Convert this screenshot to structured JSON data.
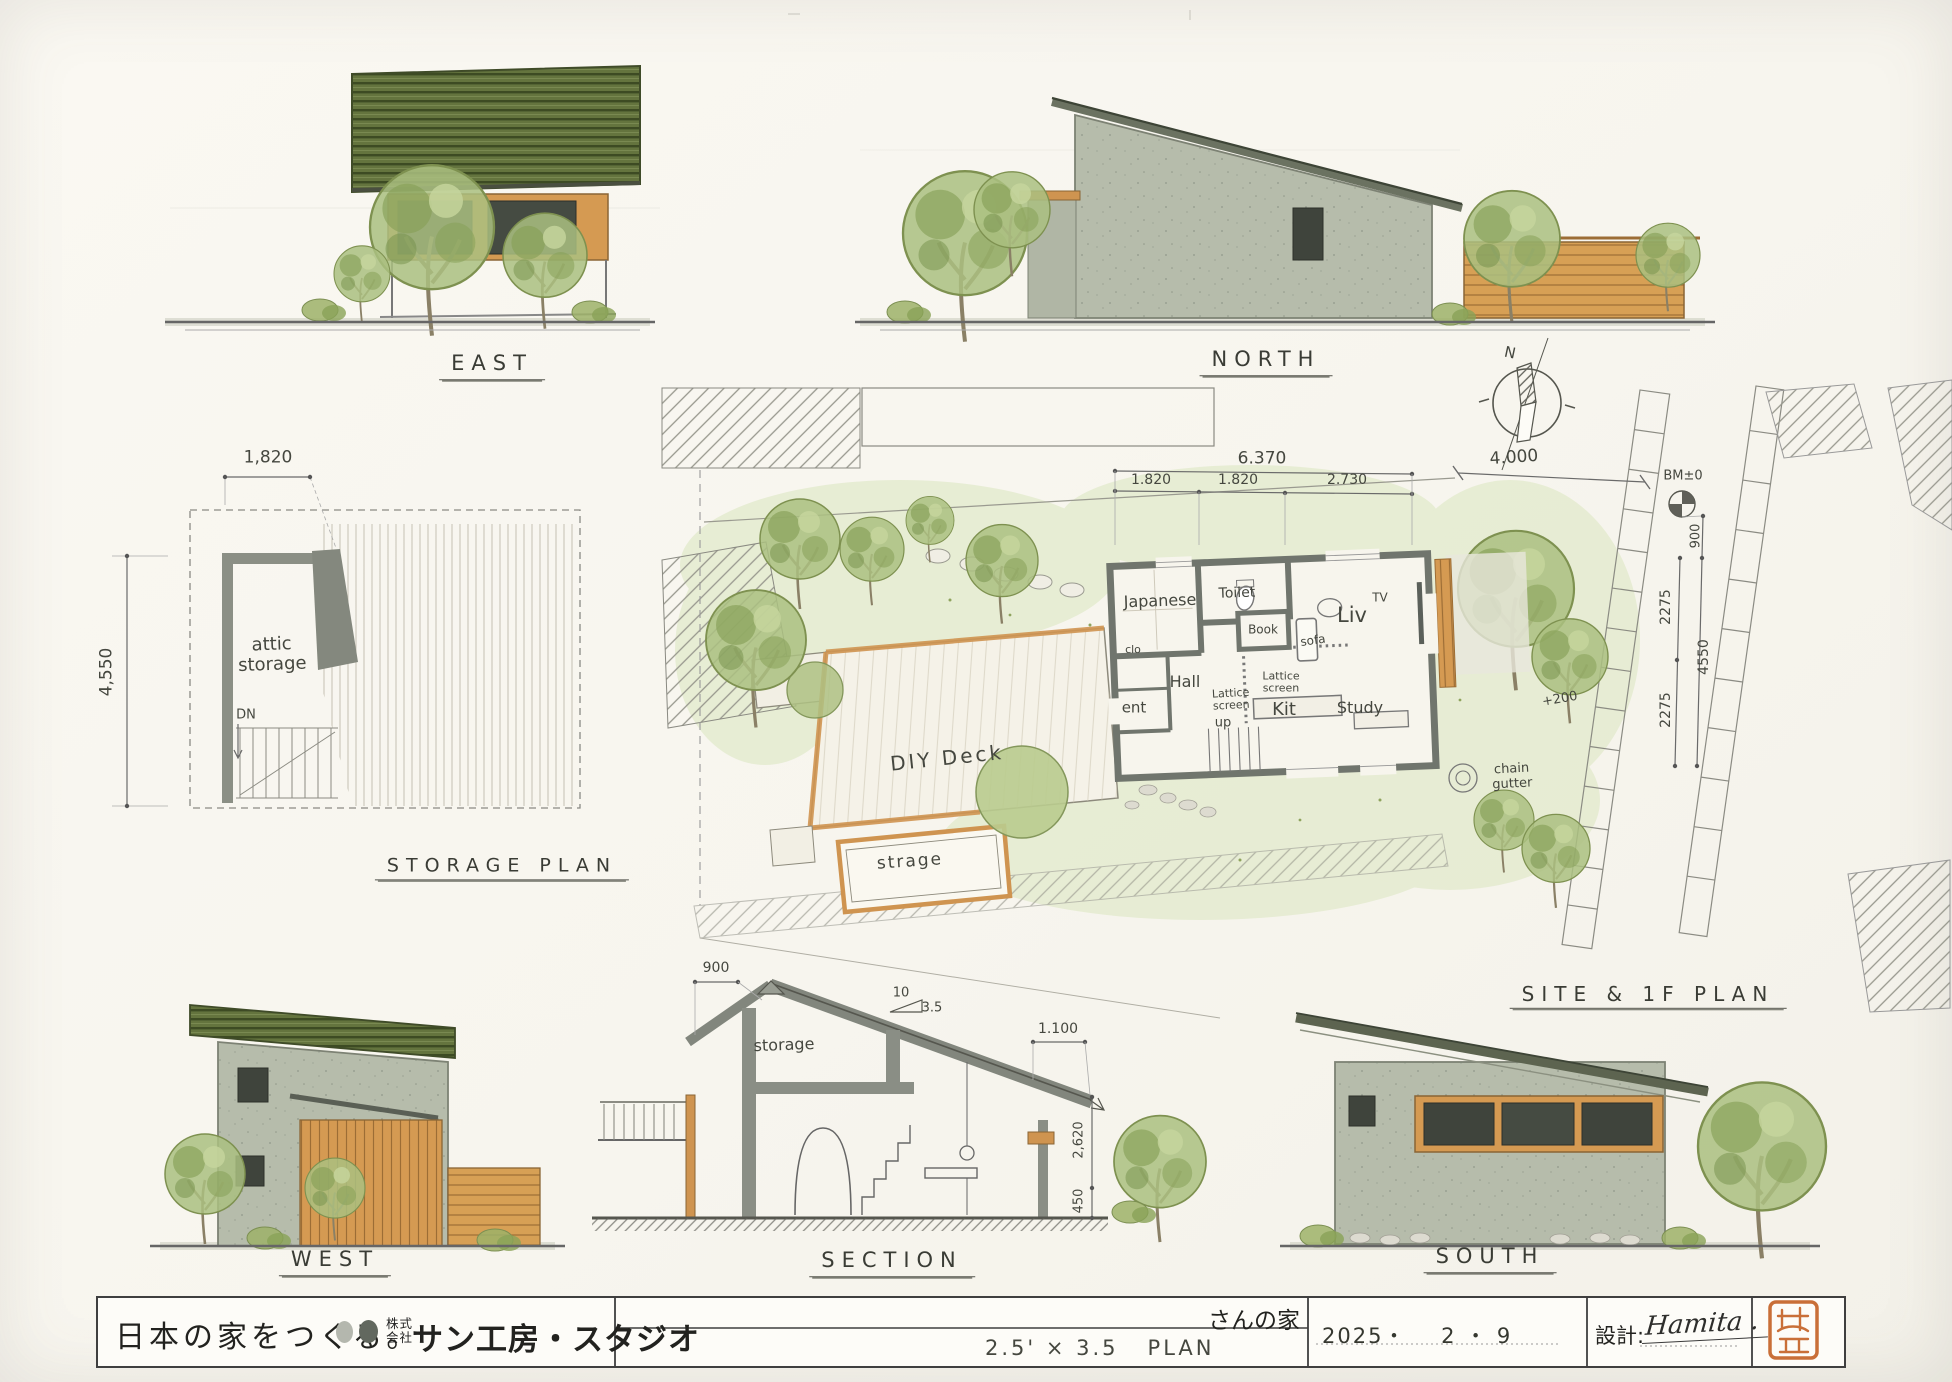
{
  "sheet": {
    "views": {
      "east": "EAST",
      "north": "NORTH",
      "west": "WEST",
      "south": "SOUTH",
      "section": "SECTION",
      "storage_plan": "STORAGE PLAN",
      "site_plan": "SITE & 1F PLAN"
    },
    "compass_n": "N"
  },
  "storage_plan": {
    "dim_width": "1,820",
    "dim_height": "4,550",
    "room": "attic\nstorage",
    "down": "DN"
  },
  "site_plan": {
    "dims": {
      "total": "6.370",
      "a": "1.820",
      "b": "1.820",
      "c": "2.730",
      "road": "4.000",
      "offset": "900",
      "upper": "2275",
      "lower": "2275",
      "depth": "4550"
    },
    "bench_mark": "BM±0",
    "level": "+200",
    "chain_gutter": "chain\ngutter",
    "rooms": {
      "japanese": "Japanese",
      "toilet": "Toilet",
      "book": "Book",
      "living": "Liv",
      "tv": "TV",
      "sofa": "sofa",
      "closet": "clo",
      "hall": "Hall",
      "entrance": "ent",
      "up": "up",
      "lattice_a": "Lattice\nscreen",
      "lattice_b": "Lattice\nscreen",
      "kitchen": "Kit",
      "study": "Study"
    },
    "deck": "DIY Deck",
    "shed": "strage"
  },
  "section": {
    "dim_ridge_offset": "900",
    "slope_run": "10",
    "slope_rise": "3.5",
    "dim_eave": "1.100",
    "room": "storage",
    "dim_upper": "2,620",
    "dim_lower": "450"
  },
  "title_block": {
    "slogan": "日本の家をつくる。",
    "company_prefix_top": "株式",
    "company_prefix_bottom": "会社",
    "company_name": "サン工房・スタジオ",
    "project_name": "さんの家",
    "plan_size": "2.5' × 3.5   PLAN",
    "date": "2025・    2 ・ 9",
    "designer_label": "設計:",
    "designer_signature": "Hamita ."
  },
  "colors": {
    "paper": "#f8f6ef",
    "roof_green": "#64743e",
    "wall_green": "#b6bcab",
    "wood": "#d59a52",
    "plan_wall": "#70756d",
    "tree_green": "#a8bc7e",
    "seal_orange": "#c96f38",
    "ink": "#4a4a4a"
  }
}
